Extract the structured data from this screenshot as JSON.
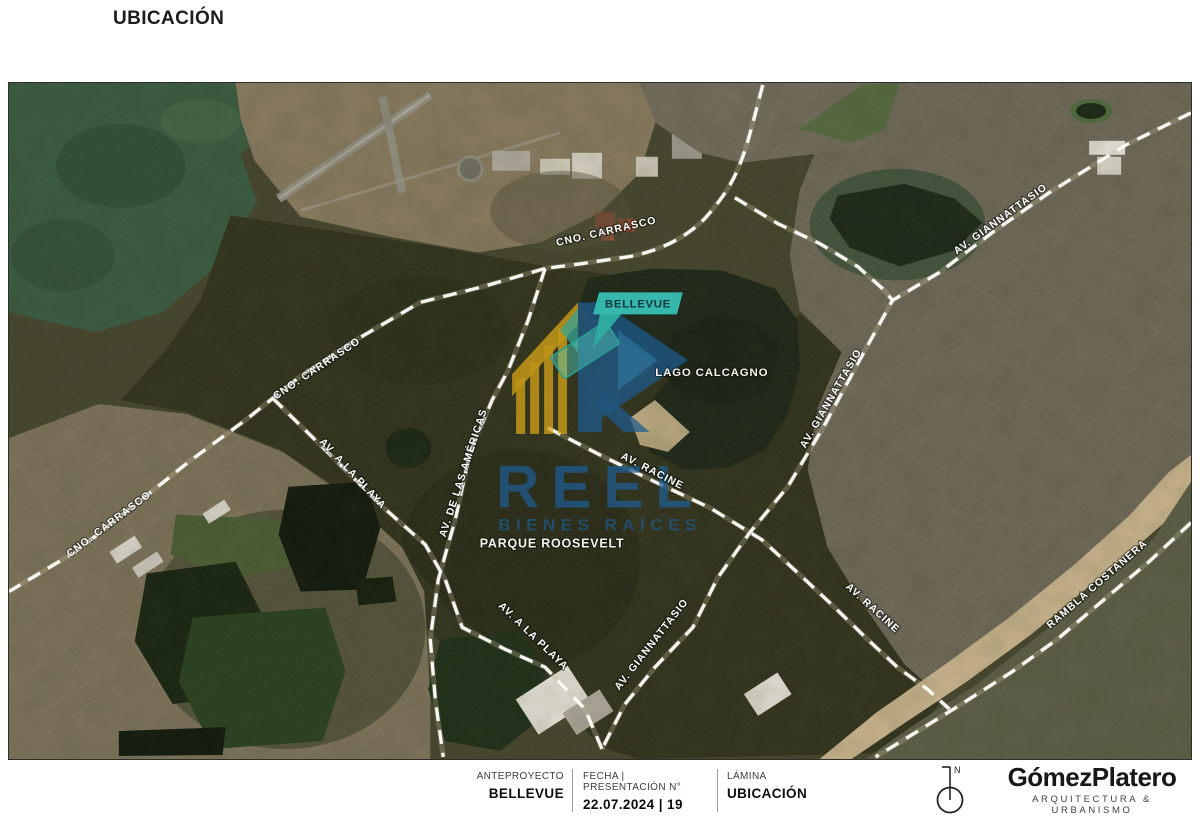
{
  "header": {
    "title": "UBICACIÓN"
  },
  "map": {
    "badge": "BELLEVUE",
    "lake_label": "LAGO CALCAGNO",
    "park_label": "PARQUE ROOSEVELT",
    "road_labels": [
      {
        "text": "CNO. CARRASCO",
        "x": 607,
        "y": 234,
        "rot": -13
      },
      {
        "text": "CNO. CARRASCO",
        "x": 318,
        "y": 371,
        "rot": -34
      },
      {
        "text": "CNO. CARRASCO",
        "x": 110,
        "y": 527,
        "rot": -37
      },
      {
        "text": "AV. GIANNATTASIO",
        "x": 1003,
        "y": 221,
        "rot": -36
      },
      {
        "text": "AV. GIANNATTASIO",
        "x": 834,
        "y": 400,
        "rot": -60
      },
      {
        "text": "AV. GIANNATTASIO",
        "x": 654,
        "y": 647,
        "rot": -52
      },
      {
        "text": "AV. DE LAS AMÉRICAS",
        "x": 466,
        "y": 474,
        "rot": -72
      },
      {
        "text": "AV. A LA PLAYA",
        "x": 350,
        "y": 476,
        "rot": 47
      },
      {
        "text": "AV. A LA PLAYA",
        "x": 531,
        "y": 639,
        "rot": 44
      },
      {
        "text": "AV. RACINE",
        "x": 651,
        "y": 474,
        "rot": 27
      },
      {
        "text": "AV. RACINE",
        "x": 871,
        "y": 611,
        "rot": 42
      },
      {
        "text": "RAMBLA COSTANERA",
        "x": 1100,
        "y": 587,
        "rot": -41
      }
    ],
    "watermark": {
      "word": "REEL",
      "tagline": "BIENES RAÍCES"
    }
  },
  "footer": {
    "columns": [
      {
        "label": "ANTEPROYECTO",
        "value": "BELLEVUE"
      },
      {
        "label": "FECHA | PRESENTACIÓN N°",
        "value": "22.07.2024 | 19"
      },
      {
        "label": "LÁMINA",
        "value": "UBICACIÓN"
      }
    ],
    "north": "N",
    "logo_name": "GómezPlatero",
    "logo_tagline": "ARQUITECTURA & URBANISMO"
  },
  "colors": {
    "badge_teal": "#36b7ab",
    "watermark_blue": "#1e5d90",
    "watermark_gold": "#d7a517"
  }
}
